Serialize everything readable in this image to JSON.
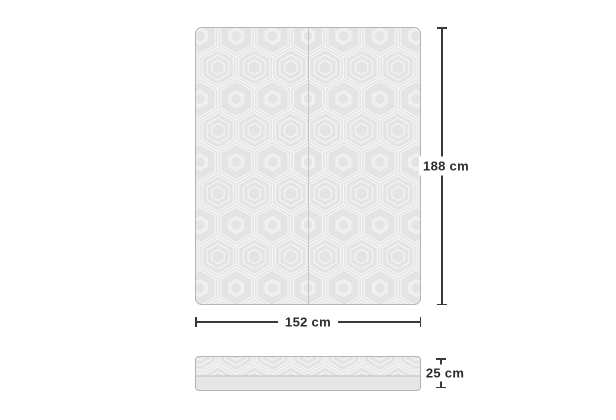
{
  "diagram": {
    "dimensions": {
      "length": {
        "label": "188 cm"
      },
      "width": {
        "label": "152 cm"
      },
      "height": {
        "label": "25 cm"
      }
    },
    "colors": {
      "background": "#ffffff",
      "mattress_fill": "#e4e4e4",
      "pattern_line": "#f7f7f7",
      "mattress_border": "#b5b5b5",
      "seam_line": "#c6c6c6",
      "base_fill": "#e6e6e6",
      "base_divider": "#bdbdbd",
      "dimension_line": "#3a3a3a",
      "label_text": "#2b2b2b"
    }
  }
}
